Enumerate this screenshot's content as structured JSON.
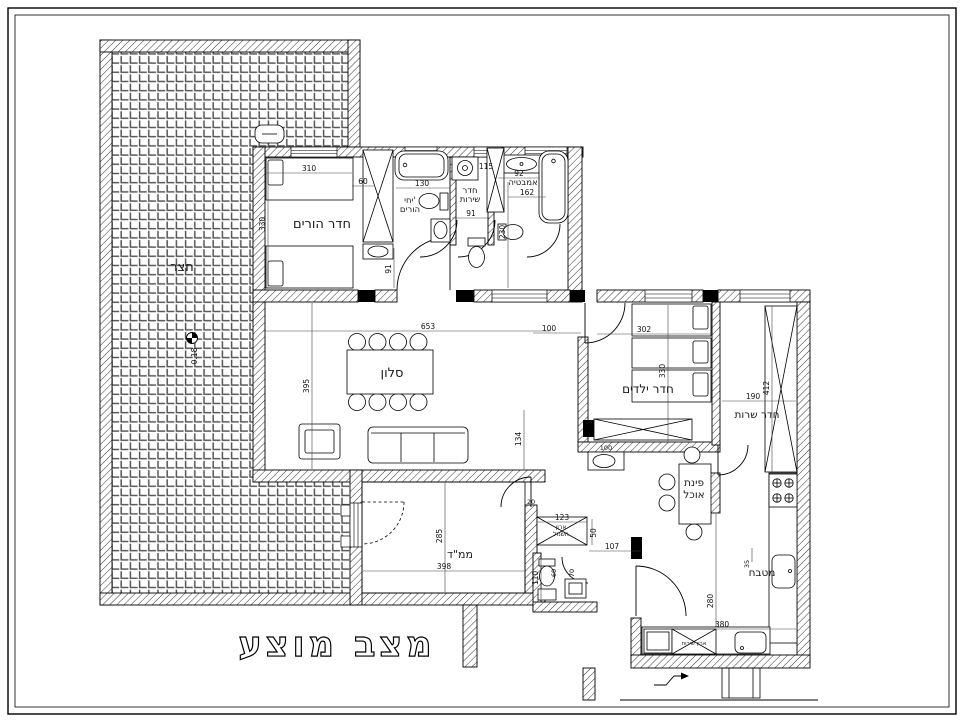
{
  "title": "מצב מוצע",
  "rooms": {
    "courtyard": "חצר",
    "parents": "חדר הורים",
    "parents_unit_1": "יחי'",
    "parents_unit_2": "הורים",
    "wc_top_1": "חדר",
    "wc_top_2": "שירות",
    "bath": "אמבטיה",
    "living": "סלון",
    "kids": "חדר ילדים",
    "utility": "חדר שרות",
    "dining_1": "פינת",
    "dining_2": "אוכל",
    "kitchen": "מטבח",
    "mamad": "ממ\"ד",
    "closet_1": "ארון",
    "closet_2": "חשמל",
    "service_closet": "ארון שירות"
  },
  "dims": {
    "parents_width": "310",
    "parents_offset": "60",
    "parents_depth": "330",
    "pbath_width": "130",
    "washer": "115",
    "pbath_len": "91",
    "wc_len": "91",
    "bath_a": "92",
    "bath_len": "162",
    "bath_depth": "230",
    "living_width": "653",
    "living_depth": "395",
    "column": "134",
    "hall": "100",
    "kids_width": "302",
    "kids_depth": "330",
    "utility_len": "412",
    "utility_width": "190",
    "mamad_depth": "285",
    "mamad_width": "398",
    "wall": "20",
    "closet_w": "123",
    "closet_d": "50",
    "hall2": "107",
    "wc2_w": "110",
    "wc2_a": "60",
    "wc2_b": "70",
    "kitchen_depth": "280",
    "kitchen_width": "380",
    "counter": "35",
    "basin": "100",
    "level": "0.18"
  }
}
